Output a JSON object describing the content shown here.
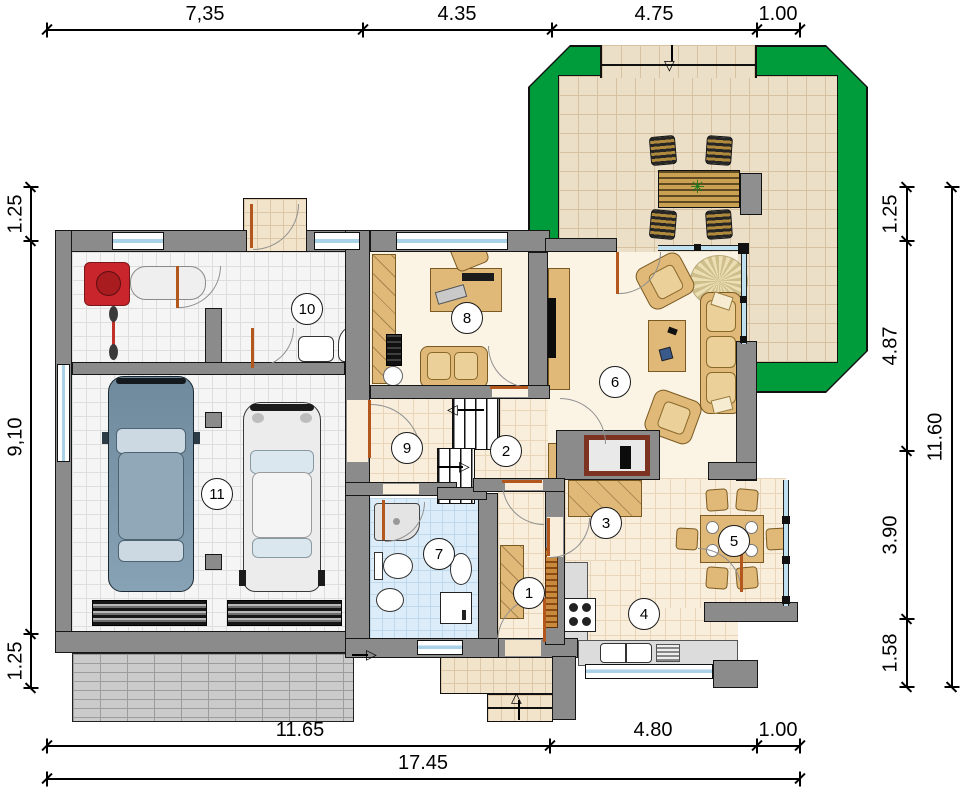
{
  "dimensions": {
    "top": [
      "7,35",
      "4.35",
      "4.75",
      "1.00"
    ],
    "left": [
      "1.25",
      "9,10",
      "1.25"
    ],
    "right_inner": [
      "1.25",
      "4.87",
      "3.90",
      "1.58"
    ],
    "right_outer": [
      "11.60"
    ],
    "bottom_inner": [
      "11.65",
      "4.80",
      "1.00"
    ],
    "bottom_outer": [
      "17.45"
    ]
  },
  "rooms": [
    {
      "number": "1"
    },
    {
      "number": "2"
    },
    {
      "number": "3"
    },
    {
      "number": "4"
    },
    {
      "number": "5"
    },
    {
      "number": "6"
    },
    {
      "number": "7"
    },
    {
      "number": "8"
    },
    {
      "number": "9"
    },
    {
      "number": "10"
    },
    {
      "number": "11"
    }
  ],
  "icons": {
    "arrow_up": "△",
    "arrow_down": "▽",
    "arrow_right": "▷",
    "arrow_left": "◁",
    "plant": "✳"
  },
  "colors": {
    "terrace_green": "#009b3a",
    "wall": "#8b8b8b",
    "wood": "#e0b878",
    "bath_tile": "#dcedf9",
    "mower_red": "#c8262c",
    "door": "#b4571c",
    "glass": "#a9d2e8"
  }
}
